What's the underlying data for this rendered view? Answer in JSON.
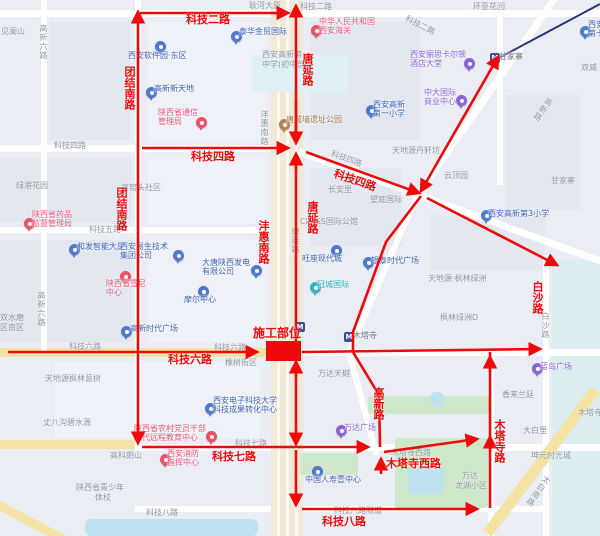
{
  "overlay": {
    "accent_color": "#ee0a0a",
    "construction_site_label": "施工部位",
    "labels": [
      {
        "text": "科技二路",
        "x": 186,
        "y": 14,
        "mode": "h"
      },
      {
        "text": "团结南路",
        "x": 123,
        "y": 66,
        "mode": "v"
      },
      {
        "text": "科技四路",
        "x": 191,
        "y": 151,
        "mode": "h"
      },
      {
        "text": "团结南路",
        "x": 115,
        "y": 187,
        "mode": "v"
      },
      {
        "text": "科技四路",
        "x": 336,
        "y": 168,
        "mode": "h",
        "rot": 19
      },
      {
        "text": "唐延路",
        "x": 301,
        "y": 53,
        "mode": "v"
      },
      {
        "text": "唐延路",
        "x": 306,
        "y": 201,
        "mode": "v"
      },
      {
        "text": "沣惠南路",
        "x": 257,
        "y": 220,
        "mode": "v"
      },
      {
        "text": "白沙路",
        "x": 531,
        "y": 281,
        "mode": "v"
      },
      {
        "text": "科技六路",
        "x": 168,
        "y": 354,
        "mode": "h"
      },
      {
        "text": "高新路",
        "x": 372,
        "y": 387,
        "mode": "v"
      },
      {
        "text": "木塔寺西路",
        "x": 386,
        "y": 458,
        "mode": "h"
      },
      {
        "text": "木塔寺路",
        "x": 493,
        "y": 419,
        "mode": "v"
      },
      {
        "text": "科技七路",
        "x": 212,
        "y": 451,
        "mode": "h"
      },
      {
        "text": "科技八路",
        "x": 322,
        "y": 516,
        "mode": "h"
      }
    ]
  },
  "base_map": {
    "colors": {
      "road_major": "#f5e3a6",
      "park": "#cfe7ca",
      "water": "#bfe2ef",
      "corridor": "#f1e9d8",
      "metro_line": "#27357e",
      "poi_blue": "#4f78cf",
      "poi_pink": "#ec5168",
      "poi_purple": "#8a63d6",
      "poi_teal": "#2bb5c4",
      "poi_brown": "#b08350",
      "metro_badge": "#3b4fa0",
      "label_gray": "#8e96a3"
    },
    "labels": [
      {
        "text": "见阑山",
        "x": 1,
        "y": 27,
        "mode": "h"
      },
      {
        "text": "高新六路",
        "x": 39,
        "y": 24,
        "mode": "v"
      },
      {
        "text": "耿河大厦",
        "x": 249,
        "y": 1,
        "mode": "h"
      },
      {
        "text": "科技二路",
        "x": 300,
        "y": 2,
        "mode": "h"
      },
      {
        "text": "科技二路",
        "x": 408,
        "y": 14,
        "mode": "h",
        "rot": 27
      },
      {
        "text": "环亚花园",
        "x": 473,
        "y": 2,
        "mode": "h"
      },
      {
        "text": "双威",
        "x": 581,
        "y": 63,
        "mode": "h"
      },
      {
        "text": "高新路",
        "x": 547,
        "y": 96,
        "mode": "v",
        "rot": 35
      },
      {
        "text": "云顶园",
        "x": 444,
        "y": 171,
        "mode": "h"
      },
      {
        "text": "甘家寨",
        "x": 551,
        "y": 176,
        "mode": "h"
      },
      {
        "text": "天地源丹轩坊",
        "x": 392,
        "y": 146,
        "mode": "h"
      },
      {
        "text": "绿港花园",
        "x": 16,
        "y": 181,
        "mode": "h"
      },
      {
        "text": "南窑头社区",
        "x": 121,
        "y": 183,
        "mode": "h"
      },
      {
        "text": "科技四路",
        "x": 54,
        "y": 141,
        "mode": "h"
      },
      {
        "text": "科技四路",
        "x": 333,
        "y": 149,
        "mode": "h",
        "rot": 20
      },
      {
        "text": "科技五路",
        "x": 89,
        "y": 225,
        "mode": "h"
      },
      {
        "text": "沣惠南路",
        "x": 260,
        "y": 110,
        "mode": "v"
      },
      {
        "text": "长安里",
        "x": 328,
        "y": 185,
        "mode": "h"
      },
      {
        "text": "望庭国际",
        "x": 370,
        "y": 195,
        "mode": "h"
      },
      {
        "text": "CLASS国际公馆",
        "x": 300,
        "y": 217,
        "mode": "h"
      },
      {
        "text": "唐延路",
        "x": 291,
        "y": 227,
        "mode": "v"
      },
      {
        "text": "高新六路",
        "x": 37,
        "y": 291,
        "mode": "v"
      },
      {
        "text": "天地源·枫林绿洲",
        "x": 428,
        "y": 274,
        "mode": "h"
      },
      {
        "text": "枫林绿洲D",
        "x": 440,
        "y": 313,
        "mode": "h"
      },
      {
        "text": "双水磨",
        "x": 0,
        "y": 313,
        "mode": "h"
      },
      {
        "text": "区南区",
        "x": 0,
        "y": 323,
        "mode": "h"
      },
      {
        "text": "科技六路",
        "x": 69,
        "y": 342,
        "mode": "h"
      },
      {
        "text": "科技六路",
        "x": 214,
        "y": 343,
        "mode": "h"
      },
      {
        "text": "橡树街区",
        "x": 225,
        "y": 358,
        "mode": "h"
      },
      {
        "text": "万达天樾",
        "x": 318,
        "y": 369,
        "mode": "h"
      },
      {
        "text": "天地源枫林意树",
        "x": 45,
        "y": 374,
        "mode": "h"
      },
      {
        "text": "丈八沟碧水源",
        "x": 43,
        "y": 418,
        "mode": "h"
      },
      {
        "text": "高科朗山",
        "x": 110,
        "y": 451,
        "mode": "h"
      },
      {
        "text": "陕西省青少年",
        "x": 76,
        "y": 483,
        "mode": "h"
      },
      {
        "text": "体校",
        "x": 95,
        "y": 493,
        "mode": "h"
      },
      {
        "text": "科技七路",
        "x": 235,
        "y": 439,
        "mode": "h"
      },
      {
        "text": "木塔寺西路",
        "x": 391,
        "y": 448,
        "mode": "h"
      },
      {
        "text": "香来兰廷",
        "x": 502,
        "y": 390,
        "mode": "h"
      },
      {
        "text": "大白里",
        "x": 523,
        "y": 426,
        "mode": "h"
      },
      {
        "text": "坤元时光城",
        "x": 531,
        "y": 451,
        "mode": "h"
      },
      {
        "text": "万达",
        "x": 462,
        "y": 471,
        "mode": "h"
      },
      {
        "text": "龙湖小区",
        "x": 455,
        "y": 481,
        "mode": "h"
      },
      {
        "text": "木塔寺",
        "x": 578,
        "y": 408,
        "mode": "h"
      },
      {
        "text": "白沙路",
        "x": 541,
        "y": 312,
        "mode": "v"
      },
      {
        "text": "太白南路",
        "x": 545,
        "y": 474,
        "mode": "v",
        "rot": 35
      },
      {
        "text": "科技八路",
        "x": 146,
        "y": 508,
        "mode": "h"
      },
      {
        "text": "科技八路隧道",
        "x": 334,
        "y": 506,
        "mode": "h"
      },
      {
        "text": "西安高新第一",
        "x": 262,
        "y": 50,
        "mode": "h"
      },
      {
        "text": "中学(初中部)",
        "x": 262,
        "y": 60,
        "mode": "h"
      }
    ],
    "pois": [
      {
        "type": "blue",
        "lines": [
          "西安软件园·东区"
        ],
        "ix": 155,
        "iy": 41,
        "tx": 128,
        "ty": 51
      },
      {
        "type": "blue",
        "lines": [
          "泰华金贸国际"
        ],
        "ix": 231,
        "iy": 31,
        "tx": 239,
        "ty": 27
      },
      {
        "type": "blue",
        "lines": [
          "高新新天地"
        ],
        "ix": 146,
        "iy": 87,
        "tx": 154,
        "ty": 84
      },
      {
        "type": "pink",
        "lines": [
          "陕西省通信",
          "管理局"
        ],
        "ix": 196,
        "iy": 117,
        "tx": 158,
        "ty": 108
      },
      {
        "type": "brown",
        "lines": [
          "唐城墙遗址公园"
        ],
        "ix": 279,
        "iy": 119,
        "tx": 286,
        "ty": 115
      },
      {
        "type": "pink",
        "lines": [
          "中华人民共和国",
          "西安海关"
        ],
        "ix": 311,
        "iy": 25,
        "tx": 319,
        "ty": 17
      },
      {
        "type": "purple",
        "lines": [
          "西安丽思卡尔顿",
          "酒店大堂"
        ],
        "ix": 464,
        "iy": 58,
        "tx": 410,
        "ty": 50
      },
      {
        "type": "purple",
        "lines": [
          "中大国际",
          "商业中心"
        ],
        "ix": 456,
        "iy": 95,
        "tx": 424,
        "ty": 88
      },
      {
        "type": "blue",
        "lines": [
          "西安高新",
          "第一小学"
        ],
        "ix": 366,
        "iy": 105,
        "tx": 373,
        "ty": 100
      },
      {
        "type": "pink",
        "lines": [
          "陕西省药品",
          "监督管理局"
        ],
        "ix": 24,
        "iy": 218,
        "tx": 32,
        "ty": 210
      },
      {
        "type": "blue",
        "lines": [
          "和发智能大厦"
        ],
        "ix": 69,
        "iy": 244,
        "tx": 77,
        "ty": 242
      },
      {
        "type": "blue",
        "lines": [
          "西安易生技术",
          "集团公司"
        ],
        "ix": 173,
        "iy": 250,
        "tx": 120,
        "ty": 242
      },
      {
        "type": "blue",
        "lines": [
          "大唐陕西发电",
          "有限公司"
        ],
        "ix": 251,
        "iy": 265,
        "tx": 202,
        "ty": 258
      },
      {
        "type": "pink",
        "lines": [
          "陕西省雪尼",
          "中心"
        ],
        "ix": 120,
        "iy": 271,
        "tx": 106,
        "ty": 279
      },
      {
        "type": "blue",
        "lines": [
          "摩尔中心"
        ],
        "ix": 198,
        "iy": 286,
        "tx": 184,
        "ty": 295
      },
      {
        "type": "teal",
        "lines": [
          "冠城国际"
        ],
        "ix": 310,
        "iy": 282,
        "tx": 317,
        "ty": 280
      },
      {
        "type": "blue",
        "lines": [
          "旺座现代城"
        ],
        "ix": 331,
        "iy": 245,
        "tx": 302,
        "ty": 254
      },
      {
        "type": "blue",
        "lines": [
          "银泰时代广场"
        ],
        "ix": 363,
        "iy": 257,
        "tx": 371,
        "ty": 256
      },
      {
        "type": "blue",
        "lines": [
          "高新时代广场"
        ],
        "ix": 121,
        "iy": 326,
        "tx": 130,
        "ty": 324
      },
      {
        "type": "blue",
        "lines": [
          "西安高新第3小学"
        ],
        "ix": 481,
        "iy": 210,
        "tx": 488,
        "ty": 209
      },
      {
        "type": "purple",
        "lines": [
          "蓝岛广场"
        ],
        "ix": 532,
        "iy": 363,
        "tx": 540,
        "ty": 362
      },
      {
        "type": "purple",
        "lines": [
          "万达广场"
        ],
        "ix": 336,
        "iy": 425,
        "tx": 344,
        "ty": 423
      },
      {
        "type": "blue",
        "lines": [
          "西安电子科技大学",
          "科技成果转化中心"
        ],
        "ix": 205,
        "iy": 403,
        "tx": 213,
        "ty": 396
      },
      {
        "type": "pink",
        "lines": [
          "陕西省农村党员干部",
          "现代远程教育中心"
        ],
        "ix": 206,
        "iy": 431,
        "tx": 134,
        "ty": 424
      },
      {
        "type": "pink",
        "lines": [
          "西安消防",
          "指挥中心"
        ],
        "ix": 160,
        "iy": 454,
        "tx": 167,
        "ty": 449
      },
      {
        "type": "blue",
        "lines": [
          "中国人寿壹中心"
        ],
        "ix": 312,
        "iy": 466,
        "tx": 305,
        "ty": 475
      },
      {
        "type": "blue",
        "lines": [
          "西安",
          "第十"
        ],
        "ix": 580,
        "iy": 26,
        "tx": 588,
        "ty": 20
      },
      {
        "type": "metro",
        "lines": [
          "甘家寨"
        ],
        "ix": 490,
        "iy": 53,
        "tx": 499,
        "ty": 52
      },
      {
        "type": "metro",
        "lines": [
          "木塔寺"
        ],
        "ix": 344,
        "iy": 332,
        "tx": 353,
        "ty": 331
      },
      {
        "type": "metro",
        "lines": [],
        "ix": 295,
        "iy": 322,
        "tx": 0,
        "ty": 0
      }
    ]
  }
}
